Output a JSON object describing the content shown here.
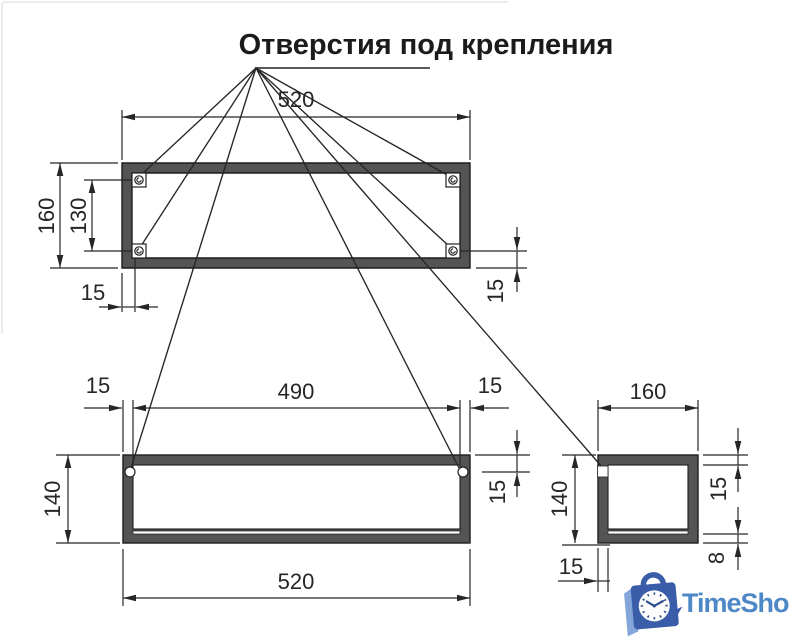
{
  "title": "Отверстия под крепления",
  "views": {
    "top": {
      "width": "520",
      "height": "160",
      "hole_spacing": "130",
      "hole_offset_x": "15",
      "hole_offset_y": "15"
    },
    "front": {
      "hole_spacing": "490",
      "offset_left": "15",
      "offset_right": "15",
      "height": "140",
      "hole_offset_top": "15",
      "width": "520"
    },
    "side": {
      "depth": "160",
      "height": "140",
      "top_wall": "15",
      "bottom_wall": "8",
      "side_wall": "15"
    }
  },
  "logo": {
    "text": "TimeShop"
  },
  "colors": {
    "bg": "#ffffff",
    "line": "#262626",
    "wall": "#545454",
    "logotext": "#4e88c7",
    "logobag": "#3a5da9",
    "logobaglight": "#84a5da",
    "clockmarks": "#30508f"
  }
}
